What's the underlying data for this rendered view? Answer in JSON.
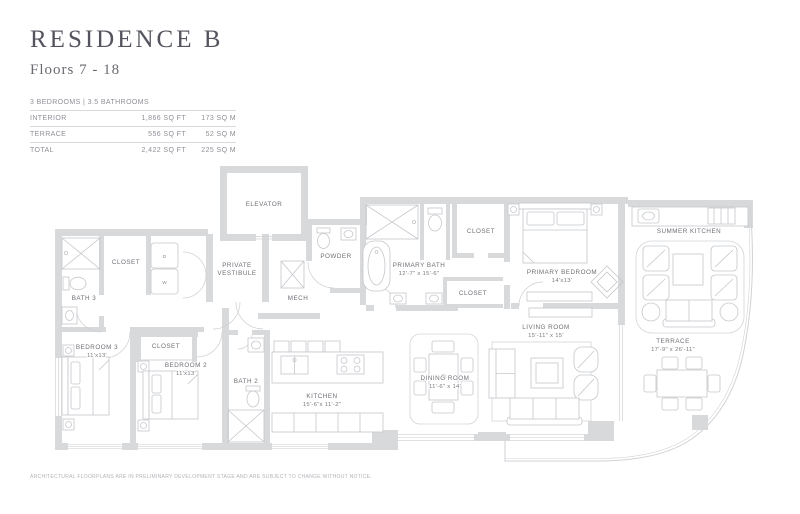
{
  "page": {
    "title": "RESIDENCE B",
    "subtitle": "Floors 7 - 18",
    "disclaimer": "ARCHITECTURAL FLOORPLANS ARE IN PRELIMINARY DEVELOPMENT STAGE AND ARE SUBJECT TO CHANGE WITHOUT NOTICE."
  },
  "stats": {
    "header": "3 BEDROOMS | 3.5 BATHROOMS",
    "rows": [
      {
        "label": "INTERIOR",
        "sqft": "1,866 SQ FT",
        "sqm": "173 SQ M"
      },
      {
        "label": "TERRACE",
        "sqft": "556 SQ FT",
        "sqm": "52 SQ M"
      },
      {
        "label": "TOTAL",
        "sqft": "2,422 SQ FT",
        "sqm": "225 SQ M"
      }
    ]
  },
  "rooms": {
    "elevator": {
      "name": "ELEVATOR"
    },
    "private_vestibule": {
      "line1": "PRIVATE",
      "line2": "VESTIBULE"
    },
    "powder": {
      "name": "POWDER"
    },
    "mech": {
      "name": "MECH"
    },
    "closet_hall": {
      "name": "CLOSET"
    },
    "bath_3": {
      "name": "BATH 3"
    },
    "bedroom_3": {
      "name": "BEDROOM 3",
      "dims": "11'x13'"
    },
    "closet_bedroom_2": {
      "name": "CLOSET"
    },
    "bedroom_2": {
      "name": "BEDROOM 2",
      "dims": "11'x13'"
    },
    "bath_2": {
      "name": "BATH 2"
    },
    "kitchen": {
      "name": "KITCHEN",
      "dims": "15'-6\"x 11'-2\""
    },
    "primary_bath": {
      "name": "PRIMARY BATH",
      "dims": "12'-7\" x 15'-6\""
    },
    "closet_primary_1": {
      "name": "CLOSET"
    },
    "closet_primary_2": {
      "name": "CLOSET"
    },
    "primary_bedroom": {
      "name": "PRIMARY BEDROOM",
      "dims": "14'x13'"
    },
    "living_room": {
      "name": "LIVING ROOM",
      "dims": "15'-11\" x 15'"
    },
    "dining_room": {
      "name": "DINING ROOM",
      "dims": "11'-6\" x 14'"
    },
    "summer_kitchen": {
      "name": "SUMMER KITCHEN"
    },
    "terrace": {
      "name": "TERRACE",
      "dims": "17'-9\" x 26'-11\""
    }
  },
  "appliances": {
    "washer": "W",
    "dryer": "D"
  },
  "colors": {
    "wall": "#d8d9db",
    "furniture_line": "#c5c7ca",
    "label_text": "#6e6f75",
    "title_text": "#53545e",
    "table_text": "#8f9097"
  }
}
